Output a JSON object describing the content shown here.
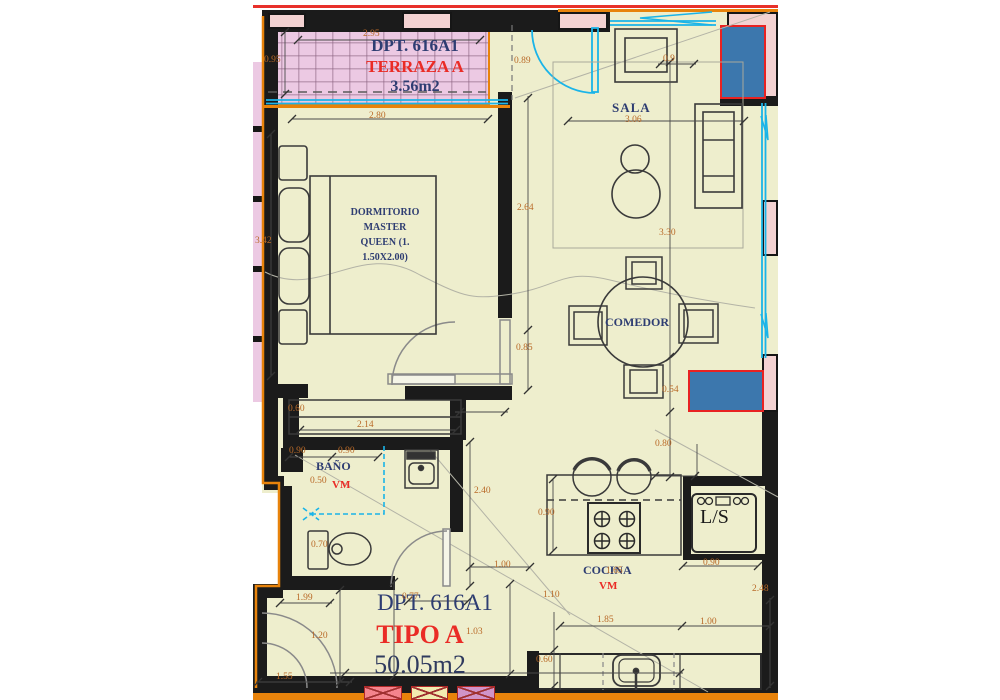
{
  "title": "Floor plan DPT. 616A1 - Tipo A",
  "rooms": {
    "terraza": {
      "dpt": "DPT. 616A1",
      "name": "TERRAZA A",
      "area": "3.56m2"
    },
    "dormitorio": {
      "label": "DORMITORIO\nMASTER\nQUEEN (1.\n1.50X2.00)"
    },
    "sala": {
      "name": "SALA"
    },
    "comedor": {
      "name": "COMEDOR"
    },
    "bano": {
      "name": "BAÑO",
      "vm": "VM"
    },
    "cocina": {
      "name": "COCINA",
      "vm": "VM",
      "appliance": "L/S"
    },
    "unit": {
      "dpt": "DPT. 616A1",
      "type": "TIPO A",
      "area": "50.05m2"
    }
  },
  "dims": {
    "terraza_width": "2.95",
    "terraza_depth": "0.95",
    "terraza_door": "0.89",
    "sala_sofa_depth": "0.9",
    "dorm_width": "2.80",
    "dorm_length": "3.42",
    "dorm_wall": "2.64",
    "dorm_door": "0.85",
    "sala_width": "3.06",
    "sala_depth": "3.30",
    "column_offset": "0.54",
    "closet_offset": "0.60",
    "closet_width": "2.14",
    "bano_w1": "0.90",
    "bano_w2": "0.90",
    "bano_050": "0.50",
    "toilet_w": "0.70",
    "bano_depth": "2.40",
    "hall_door": "1.00",
    "cocina_gap": "0.80",
    "counter_depth": "0.90",
    "ls_width": "0.90",
    "cocina_len": "1.65",
    "cocina_110": "1.10",
    "kitchen_height": "2.48",
    "counter_len": "1.85",
    "counter_right": "1.00",
    "counter_d": "0.60",
    "entry_199": "1.99",
    "entry_077": "0.77",
    "entry_120": "1.20",
    "hall_103": "1.03",
    "entry_155": "1.55"
  },
  "colors": {
    "wall": "#1b1b1b",
    "floor_cream": "#eeeecd",
    "terrace_pink": "#ecc9e3",
    "wall_infill_pink": "#f3d2d2",
    "boundary_orange": "#e8830b",
    "glazing_cyan": "#1ab4e8",
    "column_blue": "#3c77ad",
    "column_border_red": "#e82222",
    "dimension_text": "#b96a28",
    "label_navy": "#2e3d72",
    "label_red": "#ea2c26",
    "top_line_red": "#e8302a"
  }
}
